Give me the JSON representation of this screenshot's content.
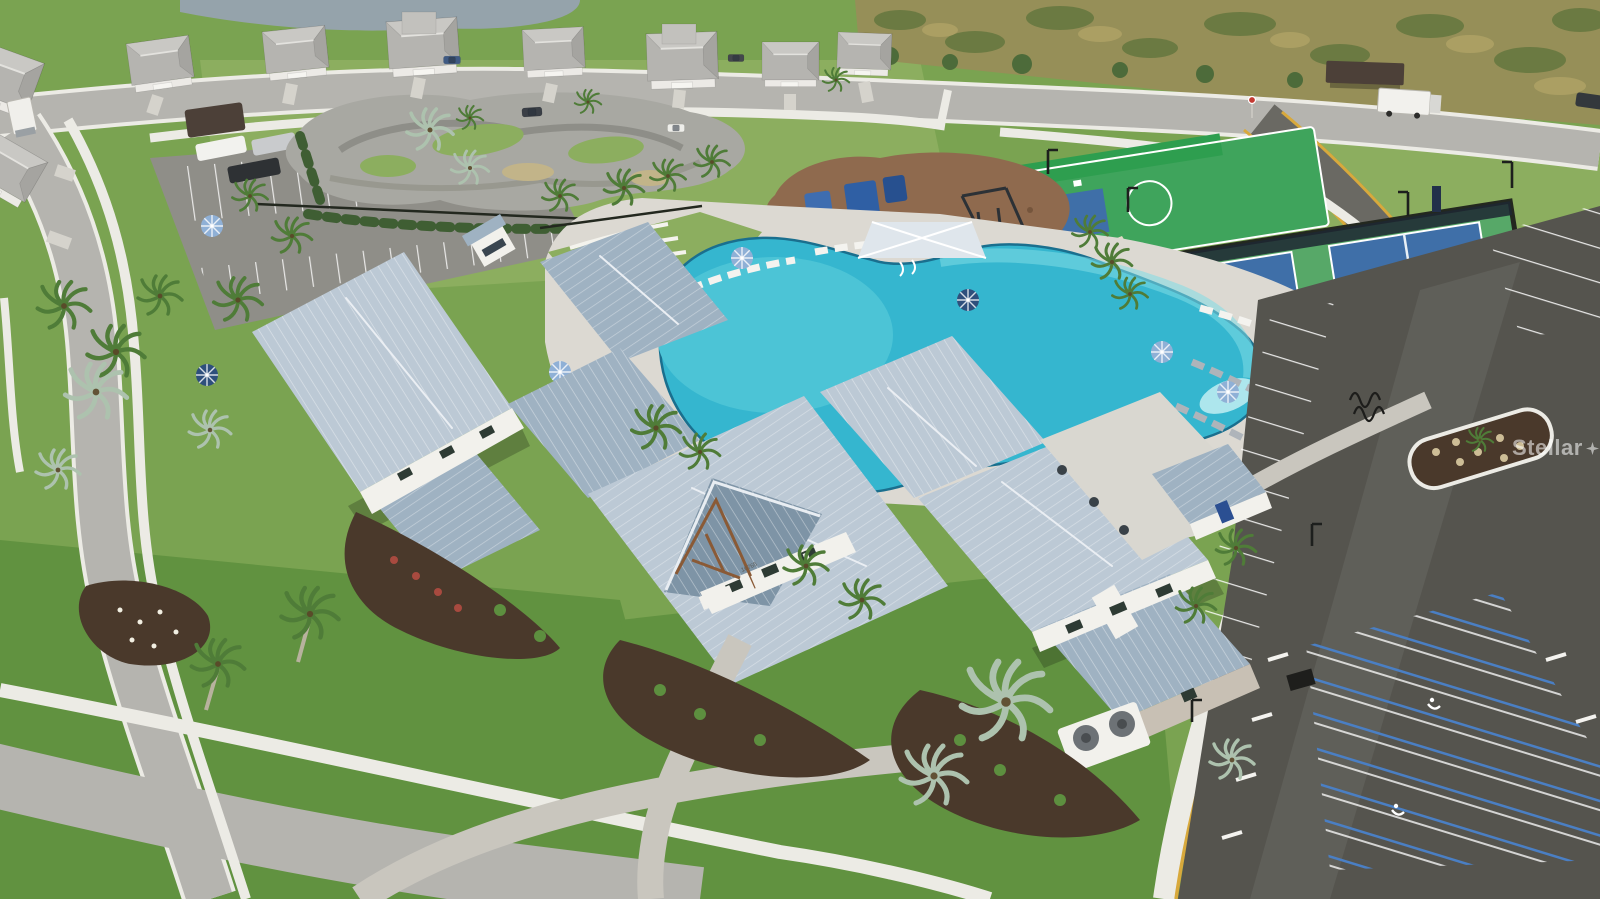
{
  "photo": {
    "watermark_prefix": "Stellar",
    "watermark_suffix": "MLS",
    "clubhouse_address": "16765"
  },
  "colors": {
    "grass": "#7aa351",
    "grassLight": "#8cae5f",
    "grassDark": "#619240",
    "preserve": "#968f58",
    "preserveDark": "#6b7a42",
    "pond": "#95a3ab",
    "road": "#b5b4af",
    "asphalt": "#55544e",
    "asphaltLight": "#6a6963",
    "sidewalk": "#ecebe5",
    "paver": "#c9c6be",
    "deck": "#dcd9d2",
    "pool": "#35b6cf",
    "poolDeep": "#1f93b8",
    "poolLight": "#7fdce6",
    "poolShallow": "#c2eff2",
    "roofLight": "#bcc9d5",
    "roofMid": "#9fb2c2",
    "roofDark": "#7e94a6",
    "ridge": "#eaeef3",
    "wall": "#f2f1ec",
    "stone": "#c8c0b4",
    "woodBrown": "#8a5a36",
    "fence": "#23281f",
    "hedge": "#3f5e33",
    "courtGreen": "#3fa45c",
    "courtBlue": "#3f6fa8",
    "playground": "#8f6a4e",
    "mulch": "#4a392b",
    "palm": "#4f7c38",
    "palmSilver": "#adc2ae",
    "trunk": "#b8b29e",
    "umbrellaBlue": "#8fb0d6",
    "umbrellaNavy": "#2e4f7c",
    "canopy": "#dfe6ec",
    "curbYellow": "#d8a93c",
    "accessBlue": "#4a7fc4",
    "white": "#f4f3ef"
  },
  "scene": {
    "elements": [
      "community-clubhouse",
      "resort-pool",
      "pool-deck",
      "lounge-chairs",
      "umbrellas",
      "shade-cabana",
      "playground",
      "pump-track",
      "basketball-court",
      "pickleball-courts",
      "parking-lot-main",
      "parking-lot-small",
      "accessible-parking",
      "single-family-homes",
      "preserve",
      "pond",
      "roads",
      "sidewalks",
      "palm-trees",
      "box-trucks",
      "bike-racks",
      "bus-shelter",
      "light-poles"
    ]
  }
}
